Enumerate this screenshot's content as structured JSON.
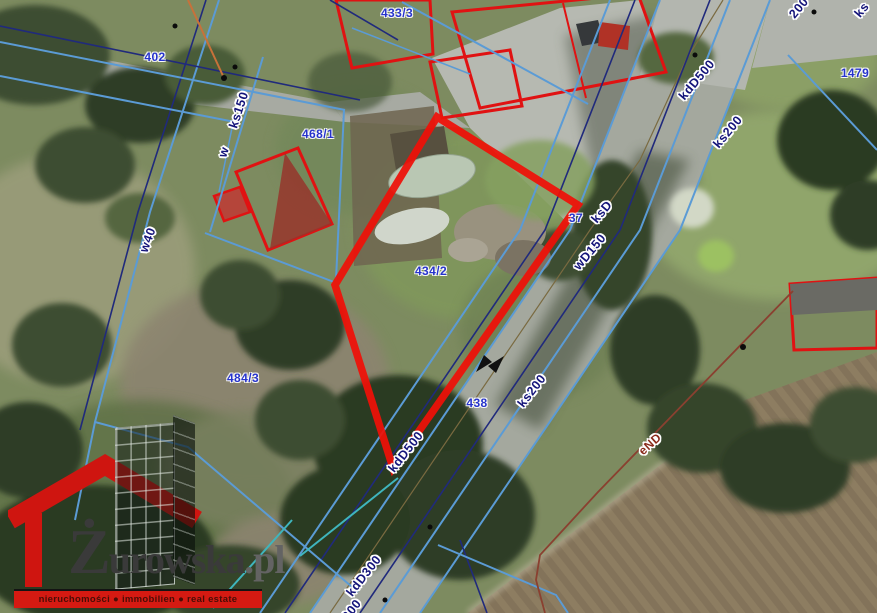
{
  "map": {
    "labels": [
      {
        "text": "402",
        "x": 155,
        "y": 57,
        "rot": 0,
        "type": "parcel"
      },
      {
        "text": "433/3",
        "x": 397,
        "y": 13,
        "rot": 0,
        "type": "parcel"
      },
      {
        "text": "468/1",
        "x": 318,
        "y": 134,
        "rot": 0,
        "type": "parcel"
      },
      {
        "text": "434/2",
        "x": 431,
        "y": 271,
        "rot": 0,
        "type": "parcel"
      },
      {
        "text": "484/3",
        "x": 243,
        "y": 378,
        "rot": 0,
        "type": "parcel"
      },
      {
        "text": "438",
        "x": 477,
        "y": 403,
        "rot": 0,
        "type": "parcel"
      },
      {
        "text": "37",
        "x": 576,
        "y": 218,
        "rot": 0,
        "type": "parcel"
      },
      {
        "text": "1479",
        "x": 855,
        "y": 73,
        "rot": 0,
        "type": "parcel"
      },
      {
        "text": "ks150",
        "x": 239,
        "y": 110,
        "rot": -72,
        "type": "utility"
      },
      {
        "text": "w",
        "x": 224,
        "y": 152,
        "rot": -72,
        "type": "utility"
      },
      {
        "text": "w40",
        "x": 148,
        "y": 240,
        "rot": -70,
        "type": "utility"
      },
      {
        "text": "kdD500",
        "x": 406,
        "y": 452,
        "rot": -52,
        "type": "utility"
      },
      {
        "text": "kdD300",
        "x": 364,
        "y": 576,
        "rot": -52,
        "type": "utility"
      },
      {
        "text": "300",
        "x": 352,
        "y": 610,
        "rot": -52,
        "type": "utility"
      },
      {
        "text": "ks200",
        "x": 532,
        "y": 391,
        "rot": -52,
        "type": "utility"
      },
      {
        "text": "wD150",
        "x": 590,
        "y": 252,
        "rot": -50,
        "type": "utility"
      },
      {
        "text": "ksD",
        "x": 602,
        "y": 212,
        "rot": -50,
        "type": "utility"
      },
      {
        "text": "kdD500",
        "x": 697,
        "y": 80,
        "rot": -50,
        "type": "utility"
      },
      {
        "text": "ks200",
        "x": 728,
        "y": 132,
        "rot": -50,
        "type": "utility"
      },
      {
        "text": "200",
        "x": 799,
        "y": 8,
        "rot": -50,
        "type": "utility"
      },
      {
        "text": "ks",
        "x": 862,
        "y": 10,
        "rot": -50,
        "type": "utility"
      },
      {
        "text": "eND",
        "x": 650,
        "y": 444,
        "rot": -42,
        "type": "power"
      }
    ]
  },
  "watermark": {
    "brand_initial": "Ż",
    "brand_rest": "urowska",
    "brand_tld": ".pl",
    "tagline": "nieruchomości ● immobilien ● real estate"
  },
  "colors": {
    "highlight_red": "#ef1008",
    "cadastral_red": "#e01212",
    "parcel_label_blue": "#2633cc",
    "utility_label_navy": "#14147a",
    "power_label_red": "#8a2a1a",
    "line_light_blue": "#5b9bd5",
    "line_navy": "#202a7c",
    "line_teal": "#3fb5bd",
    "line_orange": "#c8713a",
    "line_power": "#8a4030",
    "logo_red": "#d51a12"
  }
}
